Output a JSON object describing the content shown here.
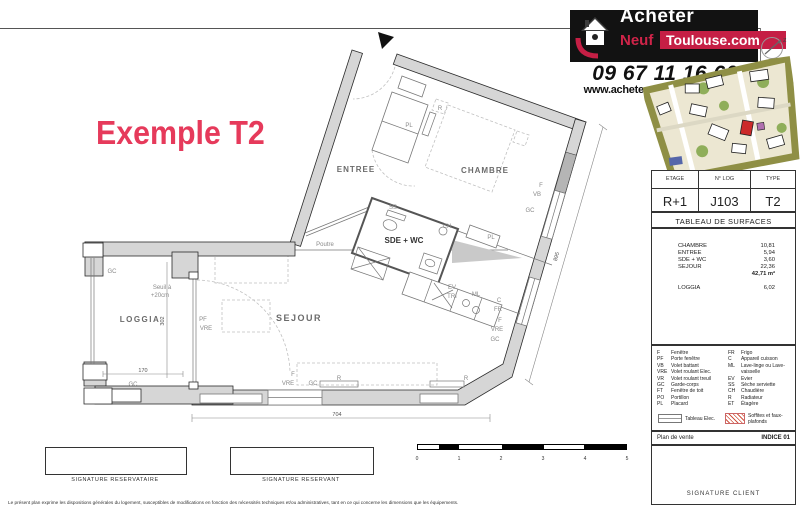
{
  "title": "Exemple T2",
  "header": {
    "logo": {
      "line1": "Acheter",
      "neuf": "Neuf",
      "toulouse": "Toulouse.com"
    },
    "phone": "09 67 11 16 60",
    "website": "www.acheter-neuf-toulouse.com"
  },
  "sidebar": {
    "info": {
      "headers": [
        "ETAGE",
        "N° LOG",
        "TYPE"
      ],
      "values": [
        "R+1",
        "J103",
        "T2"
      ]
    },
    "surfaces": {
      "title": "TABLEAU DE SURFACES",
      "rows": [
        {
          "label": "CHAMBRE",
          "value": "10,81"
        },
        {
          "label": "ENTREE",
          "value": "5,94"
        },
        {
          "label": "SDE + WC",
          "value": "3,60"
        },
        {
          "label": "SEJOUR",
          "value": "22,36"
        }
      ],
      "total": "42,71 m²",
      "loggia": {
        "label": "LOGGIA",
        "value": "6,02"
      }
    },
    "legend": {
      "left": [
        {
          "code": "F",
          "label": "Fenêtre"
        },
        {
          "code": "PF",
          "label": "Porte fenêtre"
        },
        {
          "code": "VB",
          "label": "Volet battant"
        },
        {
          "code": "VRE",
          "label": "Volet roulant Elec."
        },
        {
          "code": "VR",
          "label": "Volet roulant treuil"
        },
        {
          "code": "GC",
          "label": "Garde-corps"
        },
        {
          "code": "FT",
          "label": "Fenêtre de toit"
        },
        {
          "code": "PO",
          "label": "Portillon"
        },
        {
          "code": "PL",
          "label": "Placard"
        }
      ],
      "right": [
        {
          "code": "FR",
          "label": "Frigo"
        },
        {
          "code": "C",
          "label": "Appareil cuisson"
        },
        {
          "code": "ML",
          "label": "Lave-linge ou Lave-vaisselle"
        },
        {
          "code": "EV",
          "label": "Evier"
        },
        {
          "code": "SS",
          "label": "Sèche serviette"
        },
        {
          "code": "CH",
          "label": "Chaudière"
        },
        {
          "code": "R",
          "label": "Radiateur"
        },
        {
          "code": "ET",
          "label": "Étagère"
        }
      ],
      "symbols": [
        {
          "label": "Tableau Elec."
        },
        {
          "label": "Soffites et faux-plafonds"
        }
      ]
    },
    "footer": {
      "left": "Plan de vente",
      "right": "INDICE 01"
    },
    "signature": "SIGNATURE CLIENT"
  },
  "plan": {
    "rooms": {
      "entree": "ENTREE",
      "chambre": "CHAMBRE",
      "sejour": "SEJOUR",
      "loggia": "LOGGIA",
      "sde_wc": "SDE + WC"
    },
    "notes": {
      "poutre": "Poutre",
      "seuil_1": "Seuil à",
      "seuil_2": "+20cm"
    },
    "tags": {
      "pl_entree": "PL",
      "r_entree": "R",
      "ss": "SS",
      "ch": "CH",
      "pl_chambre": "PL",
      "ev": "EV",
      "tri": "TRI",
      "ml": "ML",
      "c": "C",
      "fr": "FR",
      "f_r1": "F",
      "vb": "VB",
      "gc_r1": "GC",
      "f_r2": "F",
      "vre_r2": "VRE",
      "gc_r2": "GC",
      "r_sej1": "R",
      "r_sej2": "R",
      "f_b": "F",
      "vre_b": "VRE",
      "gc_b": "GC",
      "gc_l1": "GC",
      "gc_l2": "GC",
      "pf": "PF",
      "vre_l": "VRE"
    },
    "dims": {
      "d704": "704",
      "d170": "170",
      "d302": "302",
      "d895": "895"
    }
  },
  "bottom": {
    "sig_left": "SIGNATURE RESERVATAIRE",
    "sig_right": "SIGNATURE RESERVANT",
    "scale_ticks": [
      "0",
      "1",
      "2",
      "3",
      "4",
      "5"
    ],
    "disclaimer": "Le présent plan exprime les dispositions générales du logement, susceptibles de modifications en fonction des nécessités techniques et/ou administratives, tant en ce qui concerne les dimensions que les équipements."
  },
  "colors": {
    "accent": "#e63a5b",
    "logo_red": "#c51f45",
    "wall_gray": "#d6d6d6"
  }
}
